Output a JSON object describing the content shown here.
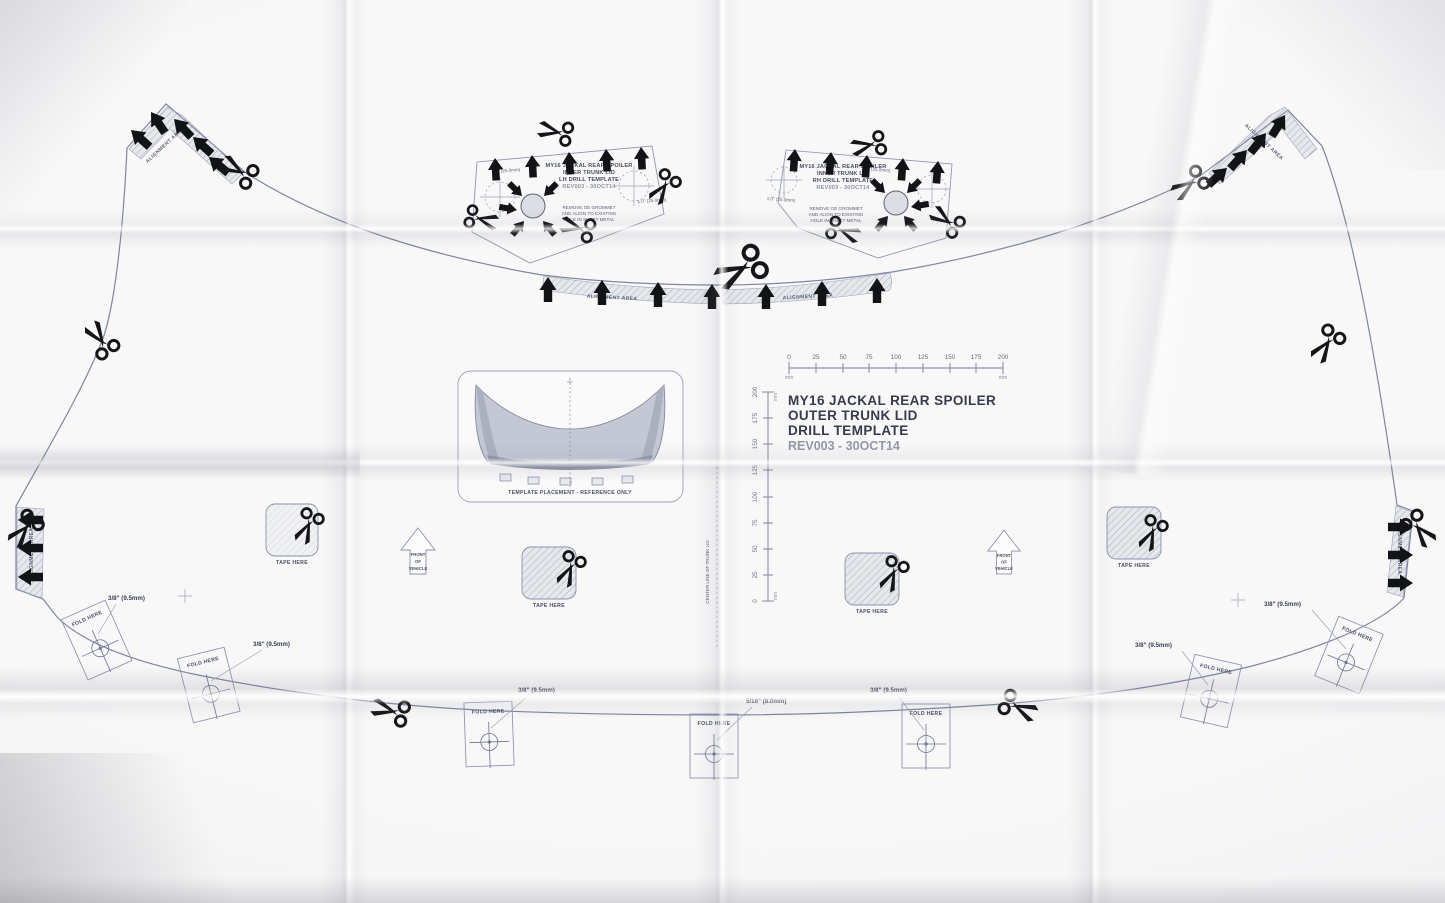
{
  "title_block": {
    "line1": "MY16 JACKAL REAR SPOILER",
    "line2": "OUTER TRUNK LID",
    "line3": "DRILL TEMPLATE",
    "line4": "REV003 - 30OCT14"
  },
  "lh_template": {
    "line1": "MY16 JACKAL REAR SPOILER",
    "line2": "INNER TRUNK LID",
    "line3": "LH DRILL TEMPLATE",
    "line4": "REV003 - 30OCT14",
    "dim_left": "1.0\" (25.0mm)",
    "dim_right": "1.0\" (25.0mm)",
    "note1": "REMOVE OE GROMMET",
    "note2": "AND ALIGN TO EXISTING",
    "note3": "HOLE IN SHEET METAL"
  },
  "rh_template": {
    "line1": "MY16 JACKAL REAR SPOILER",
    "line2": "INNER TRUNK LID",
    "line3": "RH DRILL TEMPLATE",
    "line4": "REV003 - 30OCT14",
    "dim_left": "1.0\" (25.0mm)",
    "dim_right": "1.0\" (25.0mm)",
    "note1": "REMOVE OE GROMMET",
    "note2": "AND ALIGN TO EXISTING",
    "note3": "HOLE IN SHEET METAL"
  },
  "labels": {
    "alignment_area": "ALIGNMENT AREA",
    "tape_here": "TAPE HERE",
    "front_1": "FRONT",
    "front_2": "OF",
    "front_3": "VEHICLE",
    "center_line": "CENTER LINE OF TRUNK LID",
    "template_placement": "TEMPLATE PLACEMENT - REFERENCE ONLY"
  },
  "fold_tabs": [
    {
      "fold": "FOLD HERE",
      "size": "3/8\" (9.5mm)"
    },
    {
      "fold": "FOLD HERE",
      "size": "3/8\" (9.5mm)"
    },
    {
      "fold": "FOLD HERE",
      "size": "3/8\" (9.5mm)"
    },
    {
      "fold": "FOLD HERE",
      "size": "5/16\" (8.0mm)"
    },
    {
      "fold": "FOLD HERE",
      "size": "3/8\" (9.5mm)"
    },
    {
      "fold": "FOLD HERE",
      "size": "3/8\" (9.5mm)"
    },
    {
      "fold": "FOLD HERE",
      "size": "3/8\" (9.5mm)"
    }
  ],
  "ruler": {
    "ticks": [
      "0",
      "25",
      "50",
      "75",
      "100",
      "125",
      "150",
      "175",
      "200"
    ],
    "unit": "mm"
  },
  "colors": {
    "ink_black": "#121317",
    "print_line": "#7e86a0",
    "text_dark": "#363c4c",
    "paper": "#f6f6f8"
  }
}
